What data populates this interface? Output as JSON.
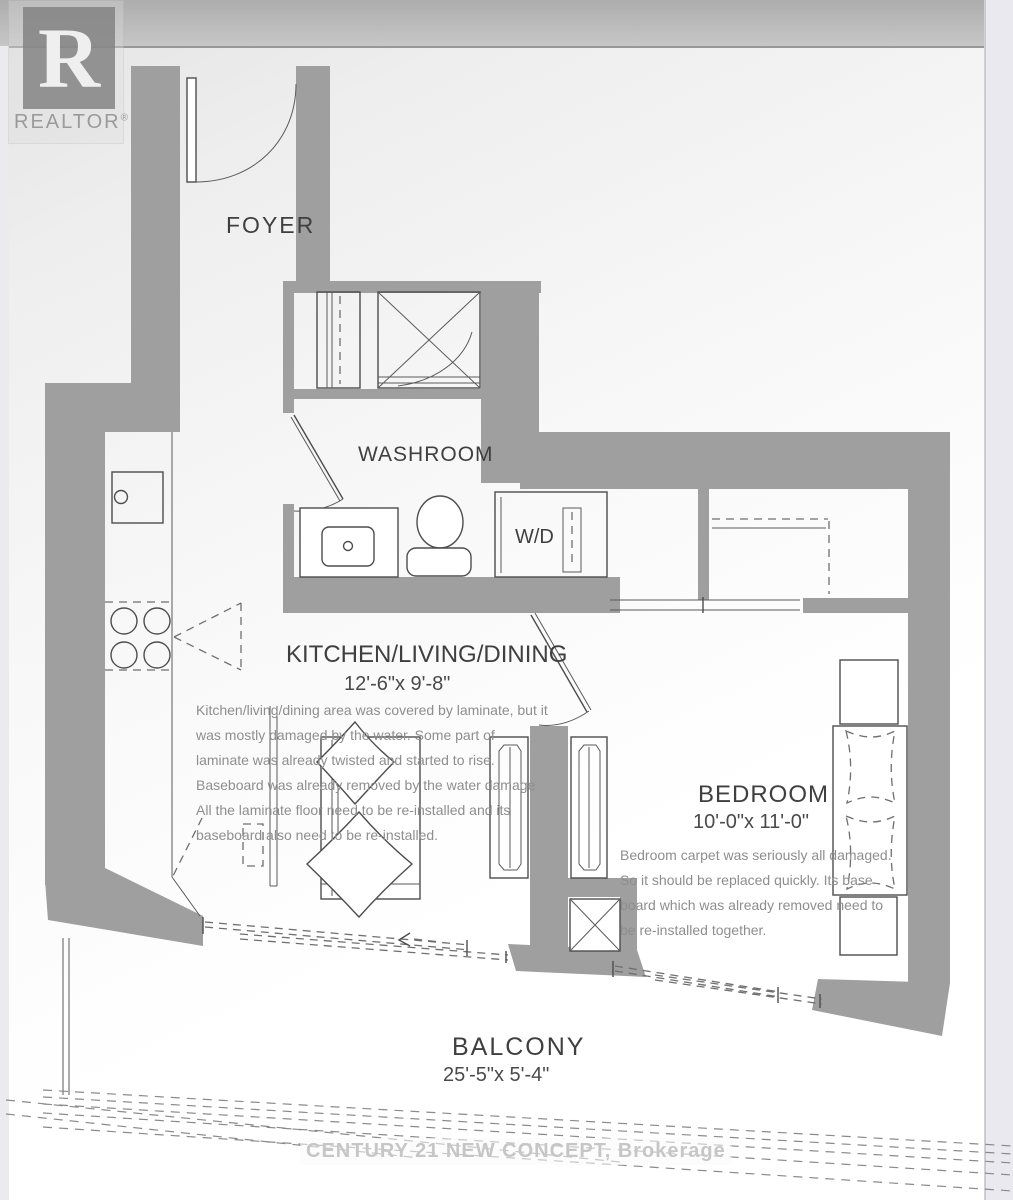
{
  "branding": {
    "logo_letter": "R",
    "logo_text": "REALTOR",
    "registered_mark": "®",
    "watermark": "CENTURY 21 NEW CONCEPT, Brokerage"
  },
  "rooms": {
    "foyer": "FOYER",
    "washroom": "WASHROOM",
    "laundry": "W/D",
    "kitchen_living_dining": "KITCHEN/LIVING/DINING",
    "kitchen_living_dining_dim": "12'-6\"x 9'-8\"",
    "bedroom": "BEDROOM",
    "bedroom_dim": "10'-0\"x 11'-0\"",
    "balcony": "BALCONY",
    "balcony_dim": "25'-5\"x 5'-4\""
  },
  "notes": {
    "kitchen": [
      "Kitchen/living/dining area was covered by laminate, but it",
      "was mostly damaged by the water. Some part of",
      "laminate was already twisted and started to rise.",
      "Baseboard was already removed by the water damage",
      "All the laminate floor need to be re-installed and its",
      "baseboard also need to be re-installed."
    ],
    "bedroom": [
      "Bedroom carpet was seriously all damaged.",
      "So it should be replaced quickly. Its base",
      "board which was already removed need to",
      "be re-installed together."
    ]
  },
  "colors": {
    "wall": "#9f9f9f",
    "line": "#4d4d4d",
    "label": "#3f3f3f",
    "note": "#8e8e8e",
    "watermark": "#c6c6c8"
  }
}
